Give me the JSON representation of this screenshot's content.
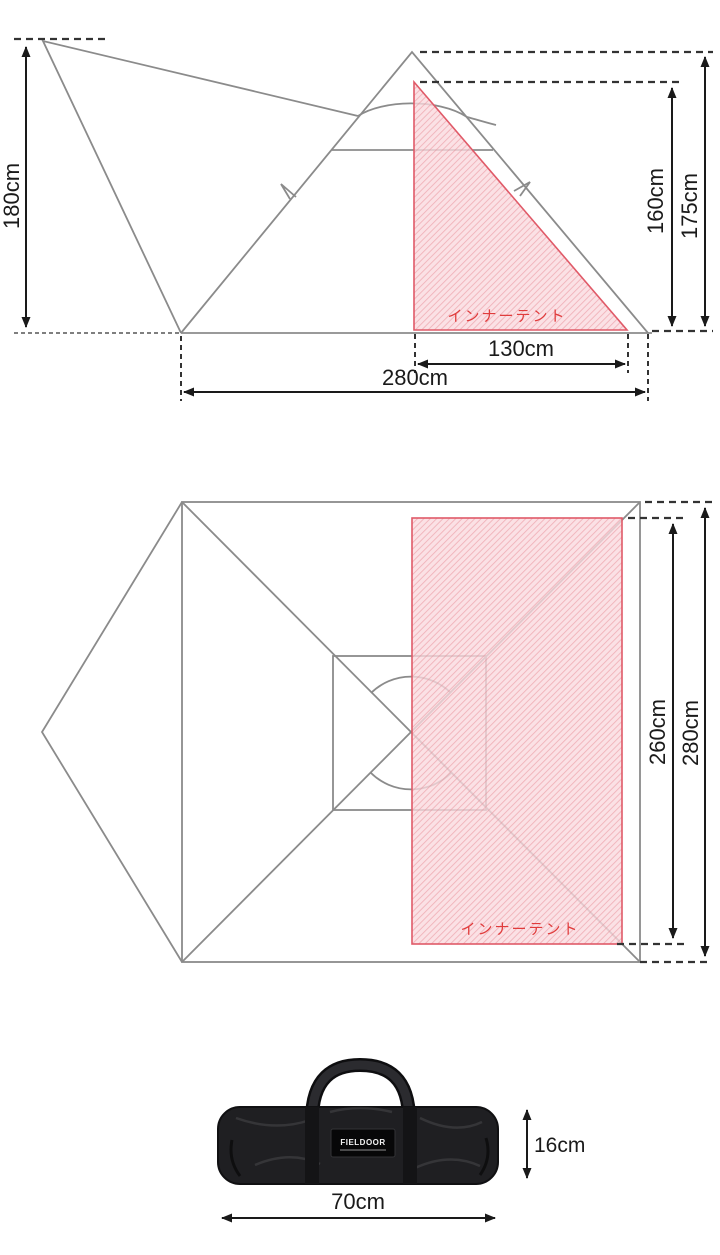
{
  "side_view": {
    "tarp_height": "180cm",
    "inner_height": "160cm",
    "peak_height": "175cm",
    "inner_width": "130cm",
    "base_width": "280cm",
    "inner_tent_label": "インナーテント"
  },
  "top_view": {
    "inner_depth": "260cm",
    "outer_depth": "280cm",
    "inner_tent_label": "インナーテント"
  },
  "bag": {
    "length": "70cm",
    "height": "16cm",
    "logo": "FIELDOOR"
  },
  "colors": {
    "line_gray": "#8b8b8b",
    "dimension_black": "#1a1a1a",
    "inner_tent_pink": "#f6ccd1",
    "inner_tent_red": "#e05a68",
    "label_red": "#e03c3c",
    "bag_black": "#1f1f22"
  }
}
